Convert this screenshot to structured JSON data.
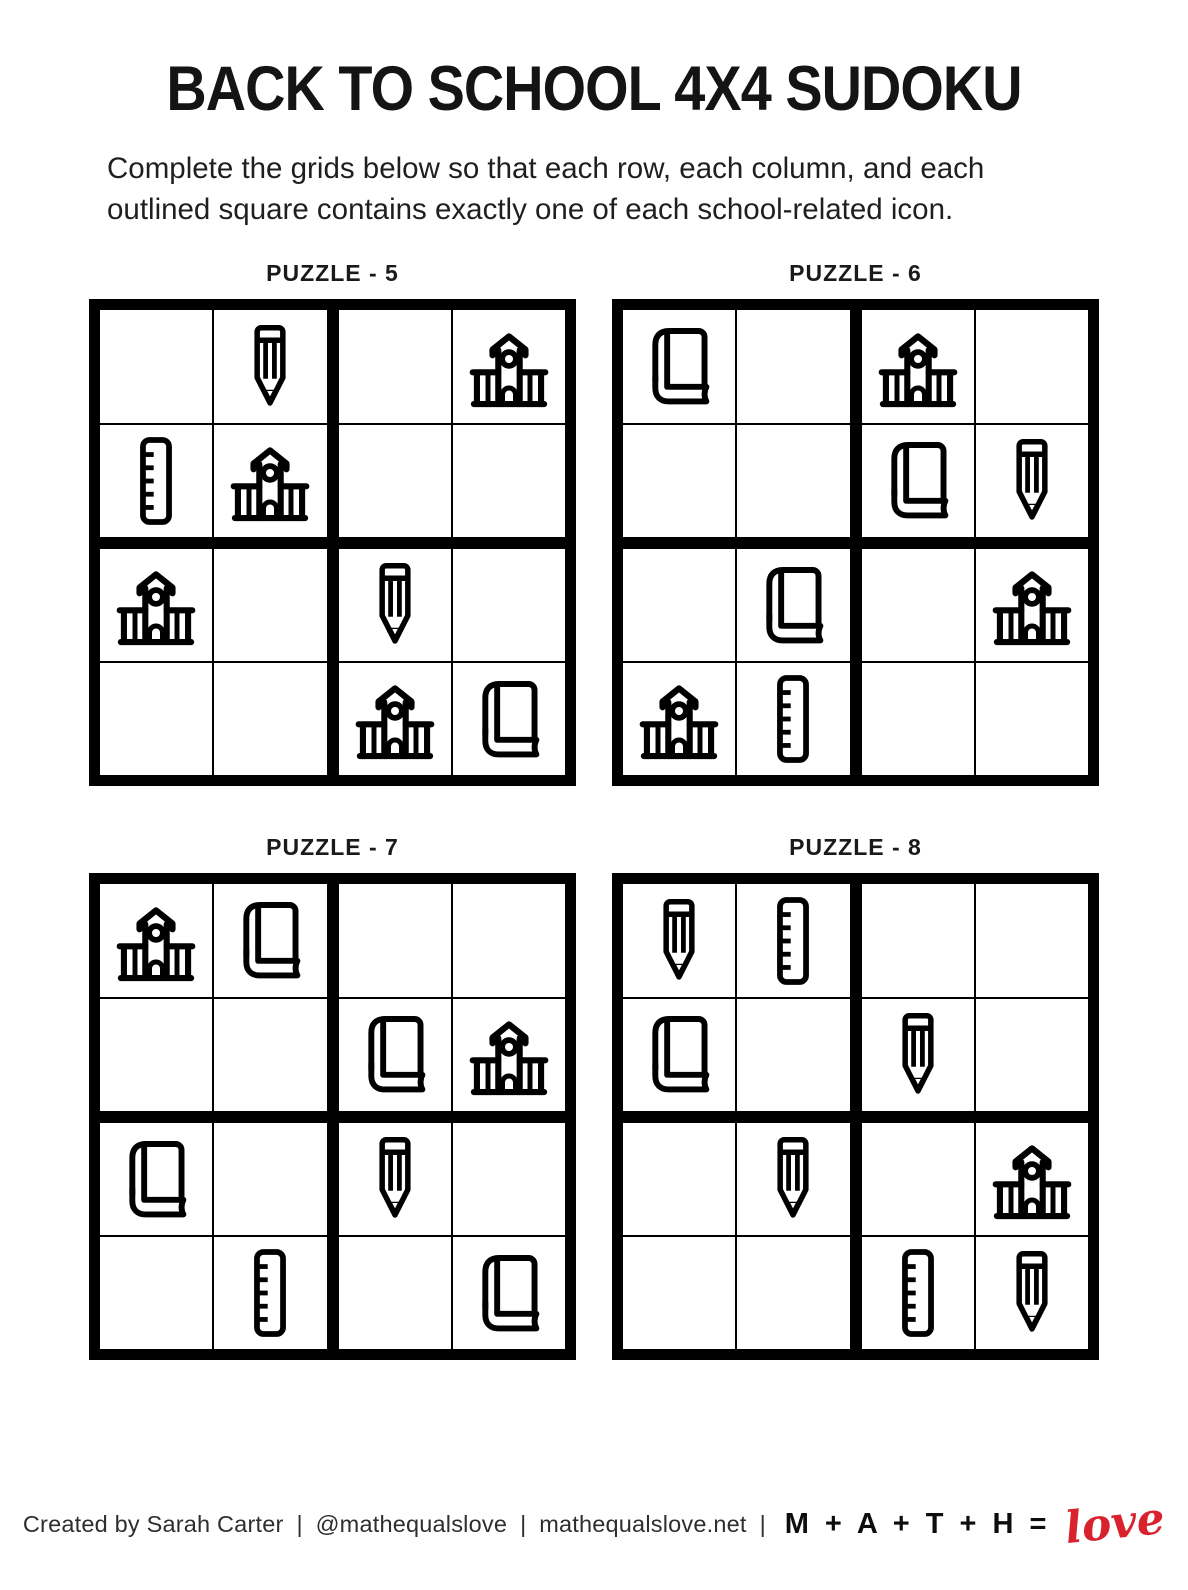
{
  "page": {
    "title": "BACK TO SCHOOL 4X4 SUDOKU",
    "instructions": "Complete the grids below so that each row, each column, and each outlined square contains exactly one of each school-related icon."
  },
  "icon_legend": {
    "pencil": "pencil-icon",
    "ruler": "ruler-icon",
    "school": "school-building-icon",
    "book": "book-icon"
  },
  "puzzles": [
    {
      "label": "PUZZLE - 5",
      "grid": [
        [
          "",
          "pencil",
          "",
          "school"
        ],
        [
          "ruler",
          "school",
          "",
          ""
        ],
        [
          "school",
          "",
          "pencil",
          ""
        ],
        [
          "",
          "",
          "school",
          "book"
        ]
      ]
    },
    {
      "label": "PUZZLE - 6",
      "grid": [
        [
          "book",
          "",
          "school",
          ""
        ],
        [
          "",
          "",
          "book",
          "pencil"
        ],
        [
          "",
          "book",
          "",
          "school"
        ],
        [
          "school",
          "ruler",
          "",
          ""
        ]
      ]
    },
    {
      "label": "PUZZLE - 7",
      "grid": [
        [
          "school",
          "book",
          "",
          ""
        ],
        [
          "",
          "",
          "book",
          "school"
        ],
        [
          "book",
          "",
          "pencil",
          ""
        ],
        [
          "",
          "ruler",
          "",
          "book"
        ]
      ]
    },
    {
      "label": "PUZZLE - 8",
      "grid": [
        [
          "pencil",
          "ruler",
          "",
          ""
        ],
        [
          "book",
          "",
          "pencil",
          ""
        ],
        [
          "",
          "pencil",
          "",
          "school"
        ],
        [
          "",
          "",
          "ruler",
          "pencil"
        ]
      ]
    }
  ],
  "footer": {
    "credit": "Created by Sarah Carter",
    "sep": "|",
    "handle": "@mathequalslove",
    "website": "mathequalslove.net",
    "brand_math": "M + A + T + H =",
    "brand_love": "love",
    "love_color": "#d8232f"
  }
}
